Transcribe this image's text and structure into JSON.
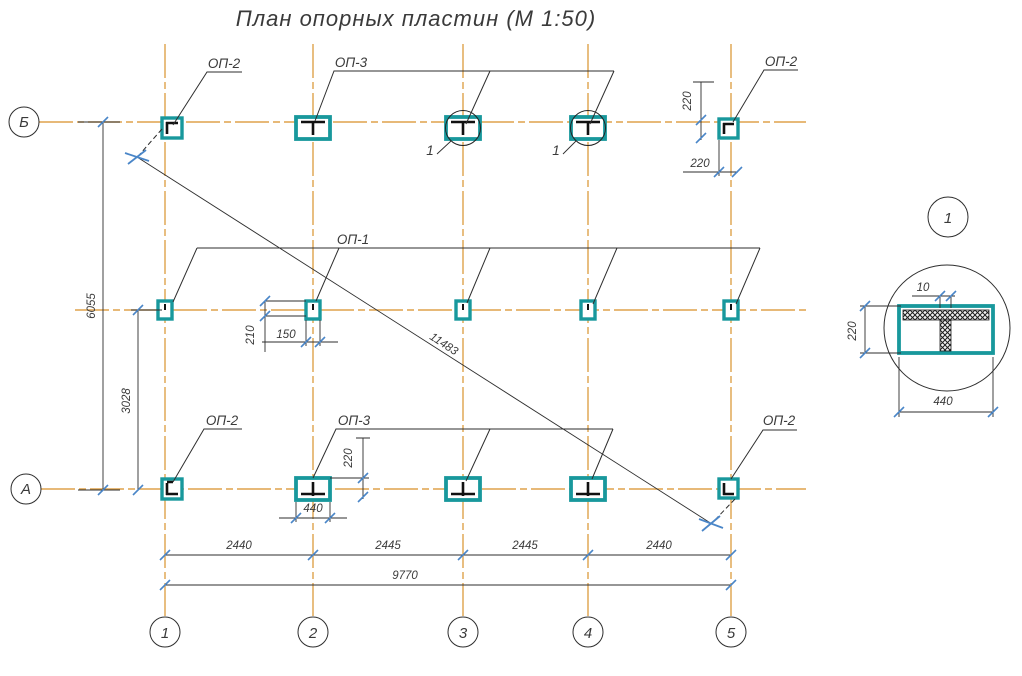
{
  "title": "План опорных пластин (М 1:50)",
  "colors": {
    "grid": "#DFA24B",
    "plate": "#18989C",
    "tick": "#4A86C8",
    "line": "#2E2E2E",
    "text": "#3A3A3A"
  },
  "axes": {
    "rows": [
      {
        "label": "Б"
      },
      {
        "label": "А"
      }
    ],
    "cols": [
      {
        "label": "1"
      },
      {
        "label": "2"
      },
      {
        "label": "3"
      },
      {
        "label": "4"
      },
      {
        "label": "5"
      }
    ]
  },
  "plate_labels": {
    "top_left": "ОП-2",
    "top_center": "ОП-3",
    "top_right": "ОП-2",
    "middle": "ОП-1",
    "bottom_left": "ОП-2",
    "bottom_center": "ОП-3",
    "bottom_right": "ОП-2"
  },
  "callouts": {
    "plate3": "1",
    "plate4": "1"
  },
  "dims": {
    "corner_v": "220",
    "corner_h": "220",
    "rows_total": "6055",
    "row_a_mid": "3028",
    "mid_plate_h": "210",
    "mid_plate_w": "150",
    "bot_plate_h": "220",
    "bot_plate_w": "440",
    "span12": "2440",
    "span23": "2445",
    "span34": "2445",
    "span45": "2440",
    "total": "9770",
    "diagonal": "11483"
  },
  "detail": {
    "ref": "1",
    "web": "10",
    "height": "220",
    "width": "440"
  }
}
